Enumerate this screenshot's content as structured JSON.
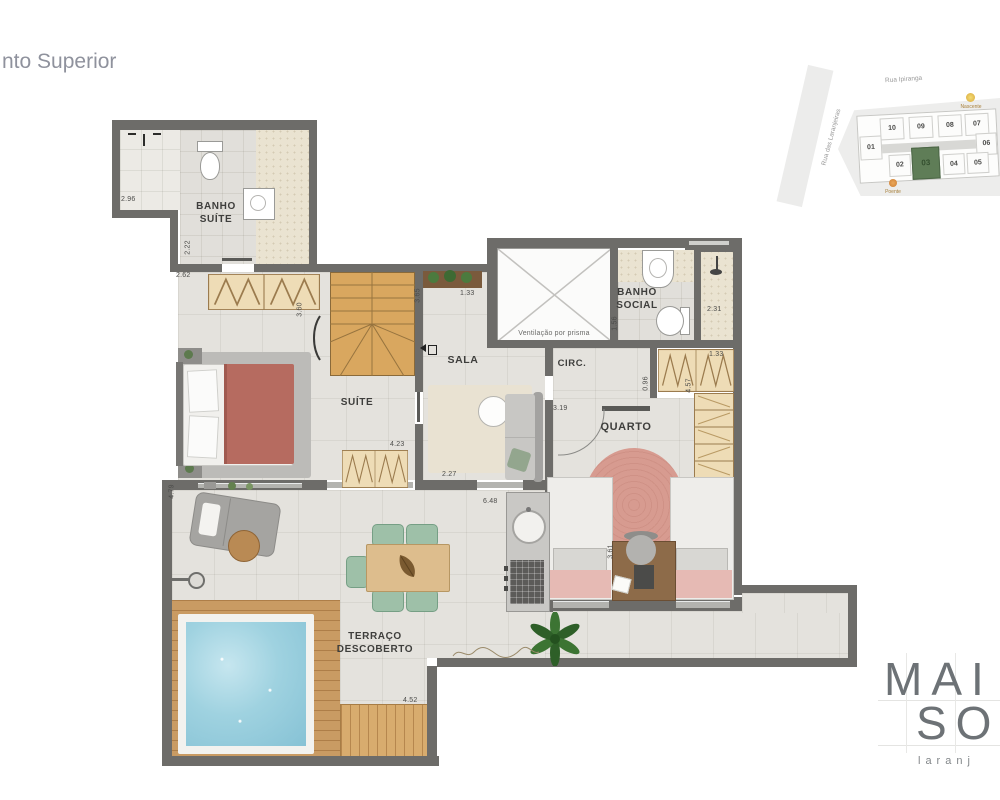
{
  "page": {
    "title": "nto Superior"
  },
  "site_map": {
    "street_top": "Rua Ipiranga",
    "street_left": "Rua das Laranjeiras",
    "sun_east_label": "Nascente",
    "sun_west_label": "Poente",
    "units_top": [
      "10",
      "09",
      "08",
      "07"
    ],
    "unit_left": "01",
    "unit_right": "06",
    "units_bottom": [
      "02",
      "03",
      "04",
      "05"
    ],
    "highlighted_unit": "03",
    "highlight_color": "#5f7d57"
  },
  "floor_plan": {
    "room_labels": {
      "banho_suite": "BANHO\nSUÍTE",
      "suite": "SUÍTE",
      "sala": "SALA",
      "ventilacao": "Ventilação por prisma",
      "banho_social": "BANHO\nSOCIAL",
      "circ": "CIRC.",
      "quarto": "QUARTO",
      "terraco": "TERRAÇO\nDESCOBERTO"
    },
    "measurements": {
      "banho_suite_shower": "2.96",
      "banho_suite_width": "2.22",
      "suite_top": "2.62",
      "suite_depth": "3.60",
      "suite_wardrobe": "4.23",
      "sala_top_v": "3.65",
      "sala_top": "1.33",
      "banho_social_v": "1.56",
      "banho_social_shower": "2.31",
      "quarto_wardrobe_top": "1.33",
      "quarto_wardrobe_v": "4.57",
      "circ_v": "0.96",
      "quarto_top": "3.19",
      "quarto_v": "3.61",
      "terraco_left_v": "4.79",
      "sala_bottom": "2.27",
      "terraco_width": "6.48",
      "terraco_bottom": "4.52"
    }
  },
  "logo": {
    "line1": "MAI",
    "line2": "SO",
    "subtitle": "laranj"
  },
  "colors": {
    "wall": "#6d6c69",
    "accent_green": "#5f7d57",
    "pool_water": "#9fd2e0",
    "wood_deck": "#c99b63",
    "bed_suite": "#b66b60",
    "rug_quarto": "#d79b90"
  }
}
